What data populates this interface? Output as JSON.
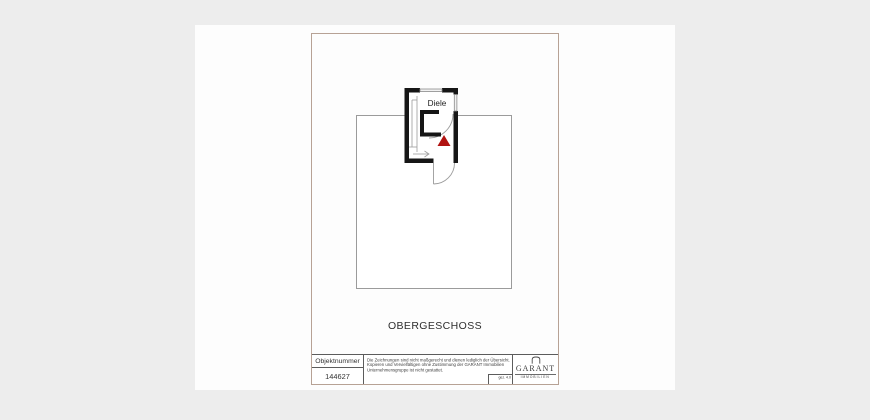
{
  "document": {
    "floor_title": "OBERGESCHOSS",
    "plan": {
      "room_label": "Diele"
    },
    "title_block": {
      "object_number_label": "Objektnummer",
      "object_number": "144627",
      "disclaimer": {
        "line1": "Die Zeichnungen sind nicht maßgerecht und dienen lediglich der Übersicht.",
        "line2": "Kopieren und Vervielfältigen ohne Zustimmung der GARANT Immobilien",
        "line3": "Unternehmensgruppe ist nicht gestattet."
      },
      "drawn_by": "gez. 4.0",
      "logo": {
        "wordmark": "GARANT",
        "subtitle": "IMMOBILIEN"
      }
    },
    "colors": {
      "page_bg": "#ededed",
      "paper": "#fdfdfd",
      "frame_border": "#b7a295",
      "wall": "#161616",
      "thin_line": "#9b9b9b",
      "accent_red": "#b11311"
    }
  }
}
